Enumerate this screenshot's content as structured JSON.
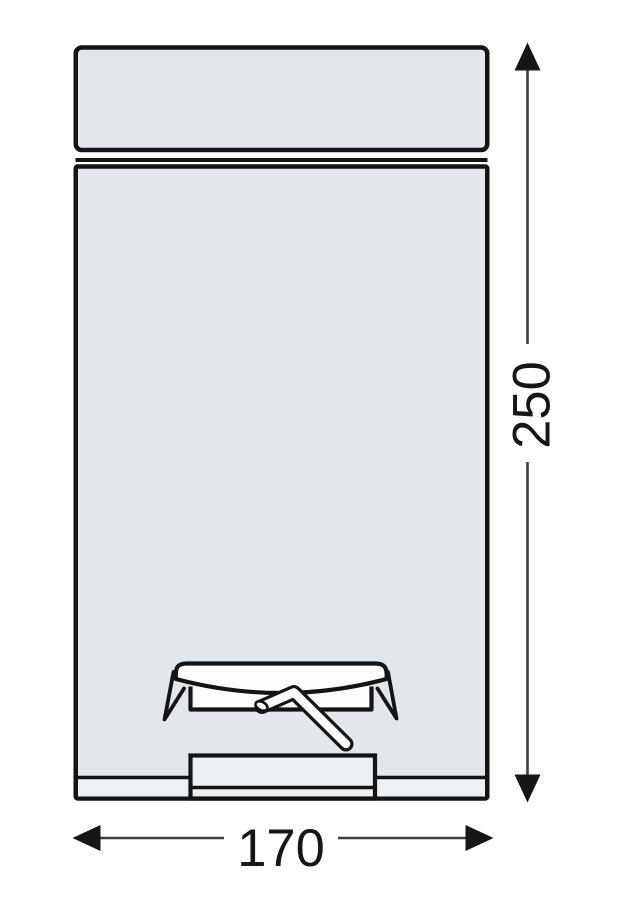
{
  "drawing": {
    "title": "pedal-bin-dimension-drawing",
    "view": "front-elevation",
    "colors": {
      "background": "#ffffff",
      "body_fill": "#e3e7eb",
      "detail_fill": "#edf0f3",
      "white_fill": "#fdfdfe",
      "outline": "#141414",
      "dimension_line": "#3f3f3f",
      "text": "#161616"
    }
  },
  "dimensions": {
    "height_value": "250",
    "width_value": "170"
  }
}
